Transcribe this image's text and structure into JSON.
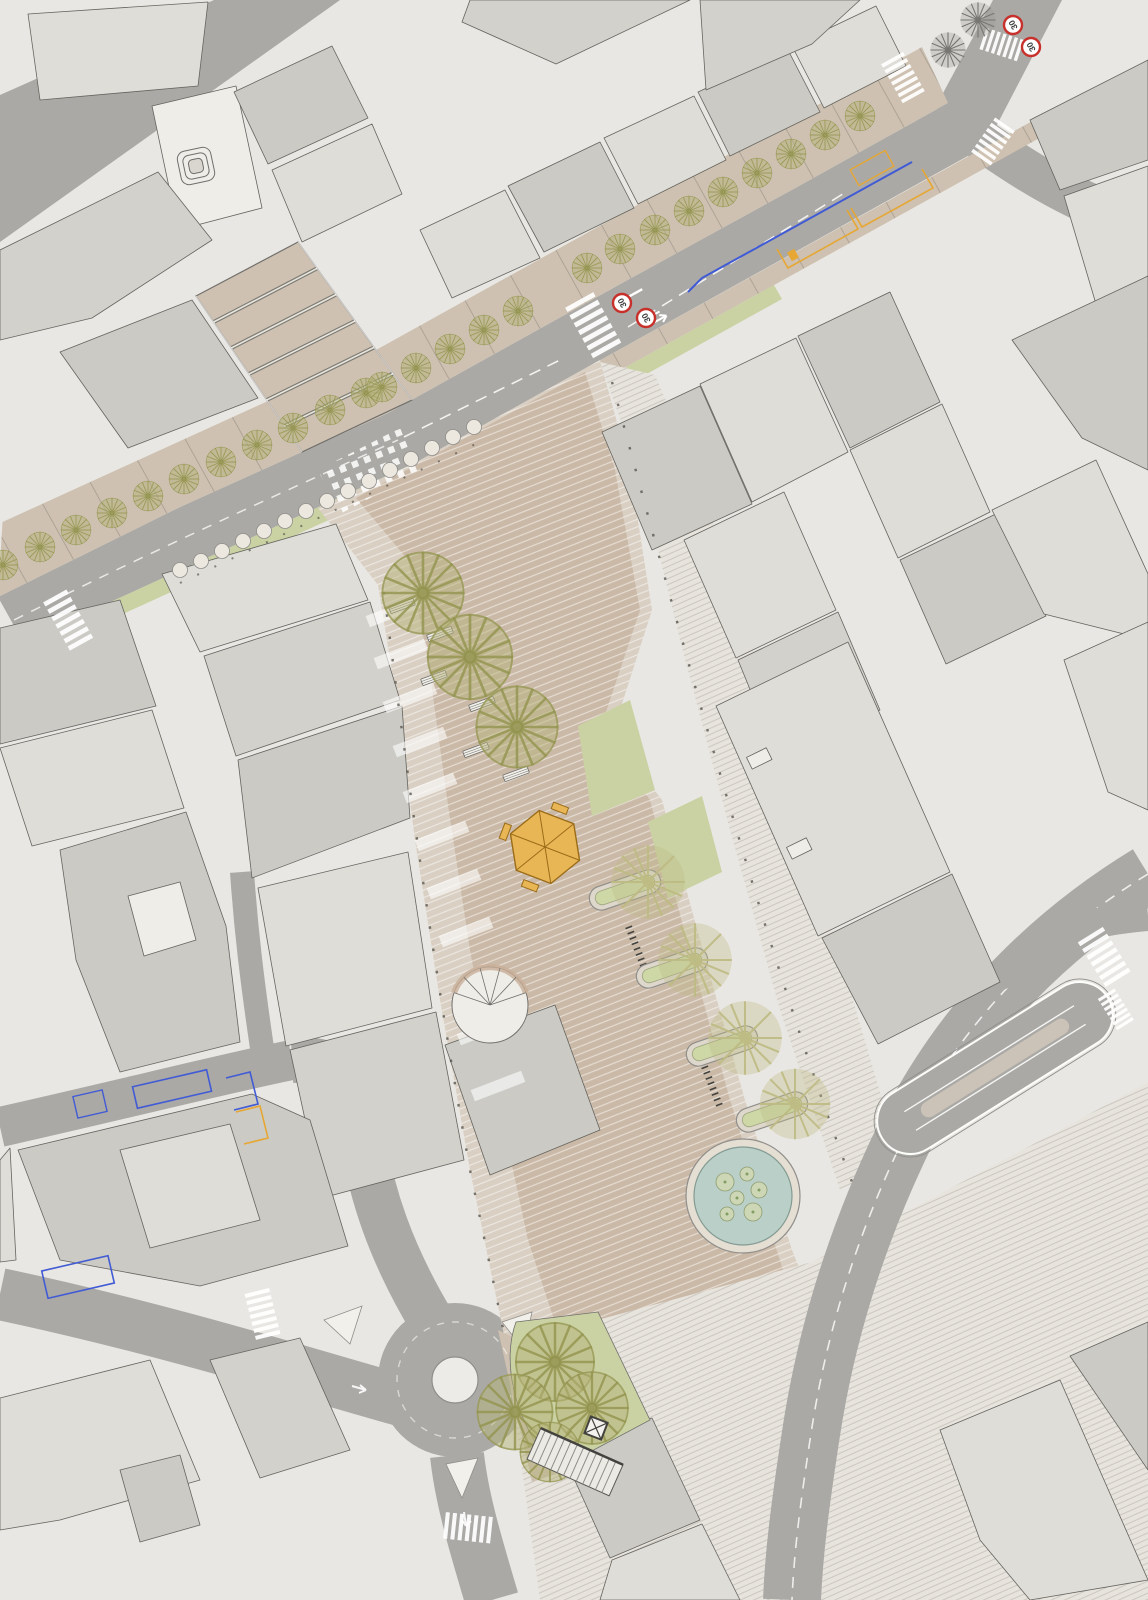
{
  "map": {
    "kind": "architectural site plan / urban masterplan",
    "signs": {
      "speed_limit_label": "30",
      "count": 4
    },
    "features": {
      "avenue_trees": 25,
      "existing_gray_trees": 2,
      "plaza_trees": 3,
      "planter_trees": 4,
      "grove_trees": 4,
      "pill_planters": 4,
      "benches": 6,
      "paving_circles": 15,
      "bike_rack_rows": 2,
      "crosswalks": 9,
      "traffic_islands": 3,
      "blue_parking_bays": 5,
      "yellow_loading_bays": 4,
      "fountain_plants": 6,
      "roundabout": "mini-roundabout",
      "kiosk": "hexagonal kiosk",
      "elevator": "x-marked shaft",
      "stepped_street_terraces": 5
    },
    "icons": {
      "tree": "radial-crown-tree-icon",
      "fountain": "circular-pond-icon",
      "kiosk": "hexagonal-kiosk-icon",
      "monument": "concentric-rounded-square-icon",
      "elevator": "x-box-elevator-icon"
    }
  },
  "colors": {
    "paper": "#e9e7e2",
    "paper-light": "#efede8",
    "building-light": "#dedcd7",
    "building-mid": "#c9c8c3",
    "building-beige": "#d2d0c9",
    "building-dark": "#bcbbb7",
    "outline": "#5f5e59",
    "road": "#a7a6a2",
    "sidewalk": "#ccbfae",
    "plaza": "#c9b7a4",
    "plaza-light": "#d8cec1",
    "esplanade": "#e7e3dc",
    "green": "#c8d1a0",
    "planter": "#ccd7a4",
    "tree": "#8f9048",
    "tree-fill": "#b3b175",
    "tree-light": "#bcb97e",
    "tree-gray": "#72716d",
    "water": "#b7cec6",
    "kiosk": "#e9b450",
    "kiosk-edge": "#97660f",
    "blue": "#3a55d4",
    "yellow": "#e5a42c",
    "red": "#c52823",
    "dot": "#48473f"
  }
}
